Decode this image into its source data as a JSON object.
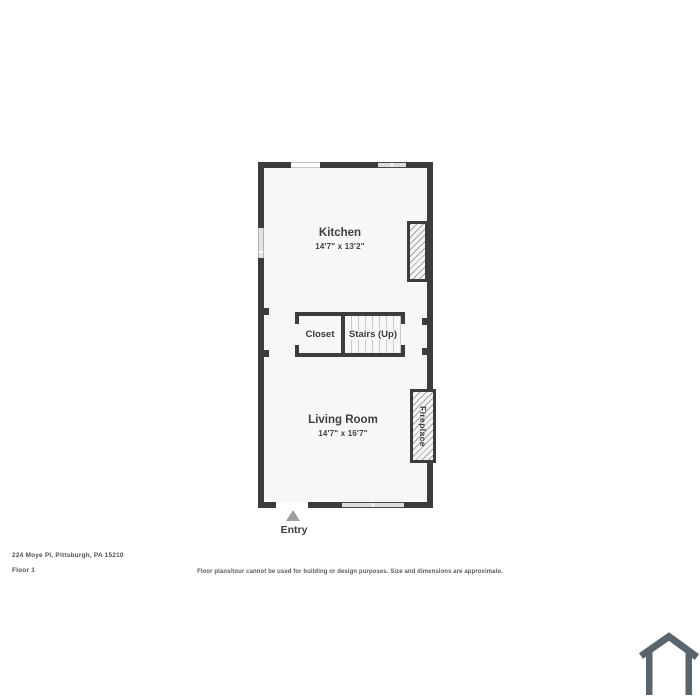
{
  "floorplan": {
    "kitchen": {
      "label": "Kitchen",
      "dimensions": "14'7\" x 13'2\""
    },
    "living_room": {
      "label": "Living Room",
      "dimensions": "14'7\" x 16'7\""
    },
    "closet": {
      "label": "Closet"
    },
    "stairs": {
      "label": "Stairs (Up)"
    },
    "fireplace": {
      "label": "Fireplace"
    },
    "entry": {
      "label": "Entry"
    }
  },
  "footer": {
    "address": "224 Moye Pl, Pittsburgh, PA 15210",
    "floor": "Floor 1",
    "disclaimer": "Floor plans/tour cannot be used for building or design purposes. Size and dimensions are approximate."
  },
  "icons": {
    "entry_marker": "triangle-up-icon",
    "brand": "house-icon"
  },
  "colors": {
    "wall": "#3c3c3c",
    "floor": "#f7f7f6",
    "window_fill": "#dcdcdc",
    "entry_arrow": "#9f9f9f",
    "logo": "#5a646d",
    "text": "#3f3f3f"
  }
}
